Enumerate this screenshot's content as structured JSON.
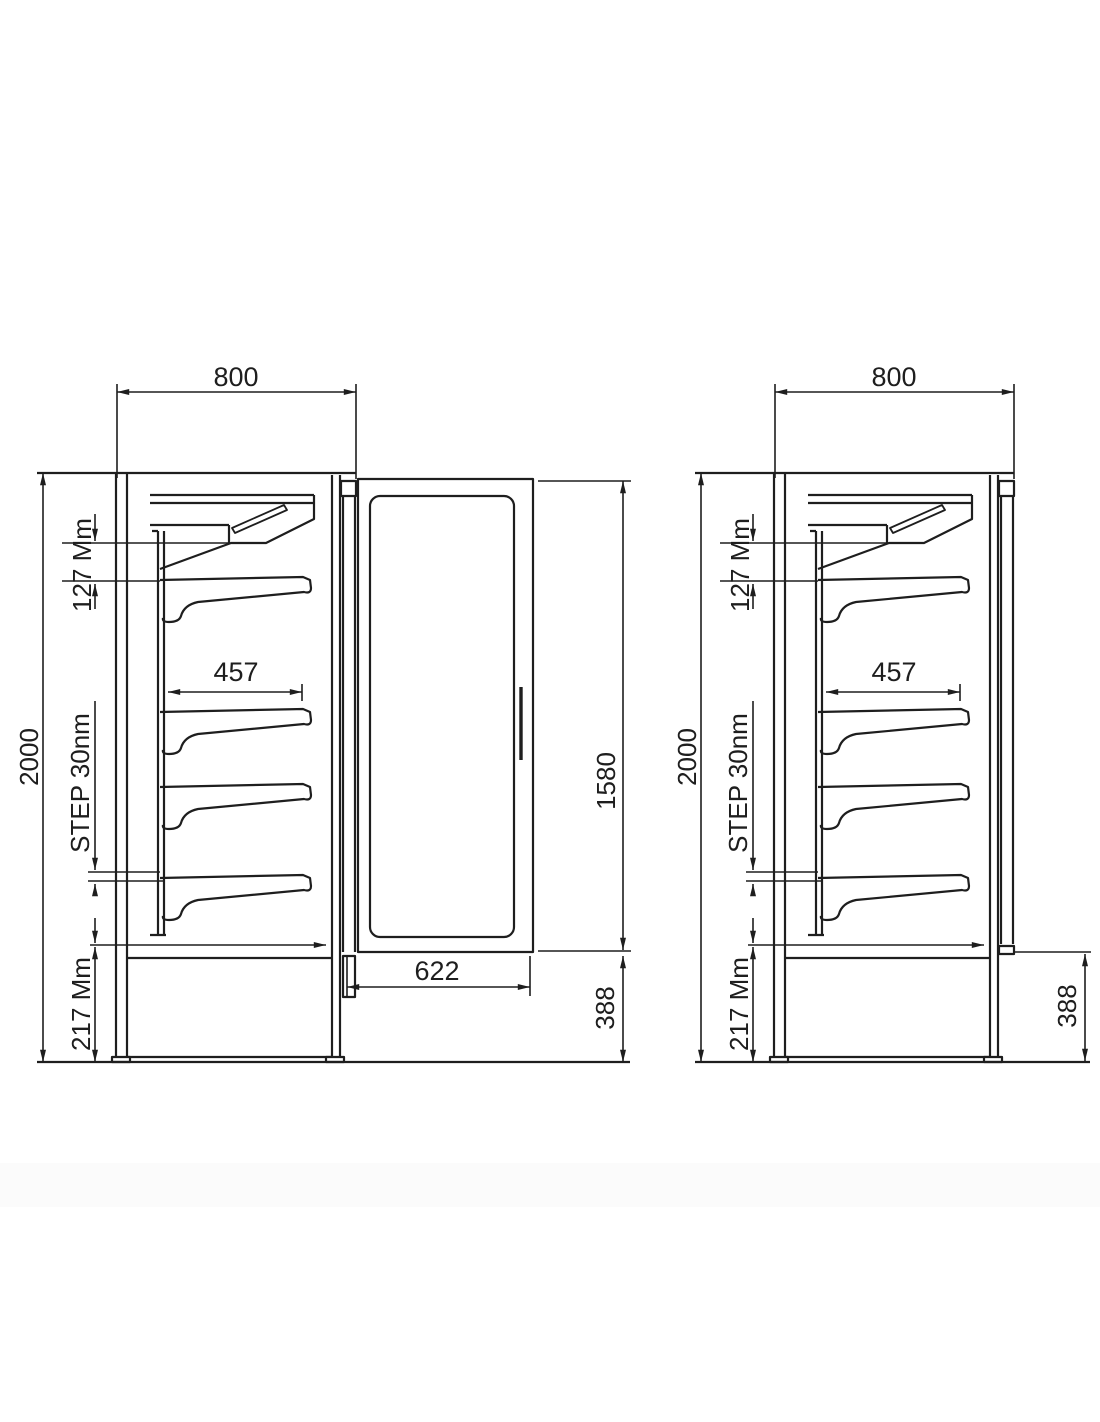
{
  "drawing": {
    "type": "technical-dimension-drawing",
    "subject": "refrigerated display cabinet side views",
    "colors": {
      "line": "#1e1e1e",
      "background": "#ffffff"
    }
  },
  "dimensions": {
    "common": {
      "width": "800",
      "height": "2000",
      "canopy_offset": "127 Mm",
      "shelf_depth": "457",
      "shelf_step": "STEP 30nm",
      "base_height": "217 Mm"
    },
    "left_door": {
      "height": "1580",
      "width": "622"
    },
    "left_base_front": "388",
    "right_base_front": "388"
  }
}
